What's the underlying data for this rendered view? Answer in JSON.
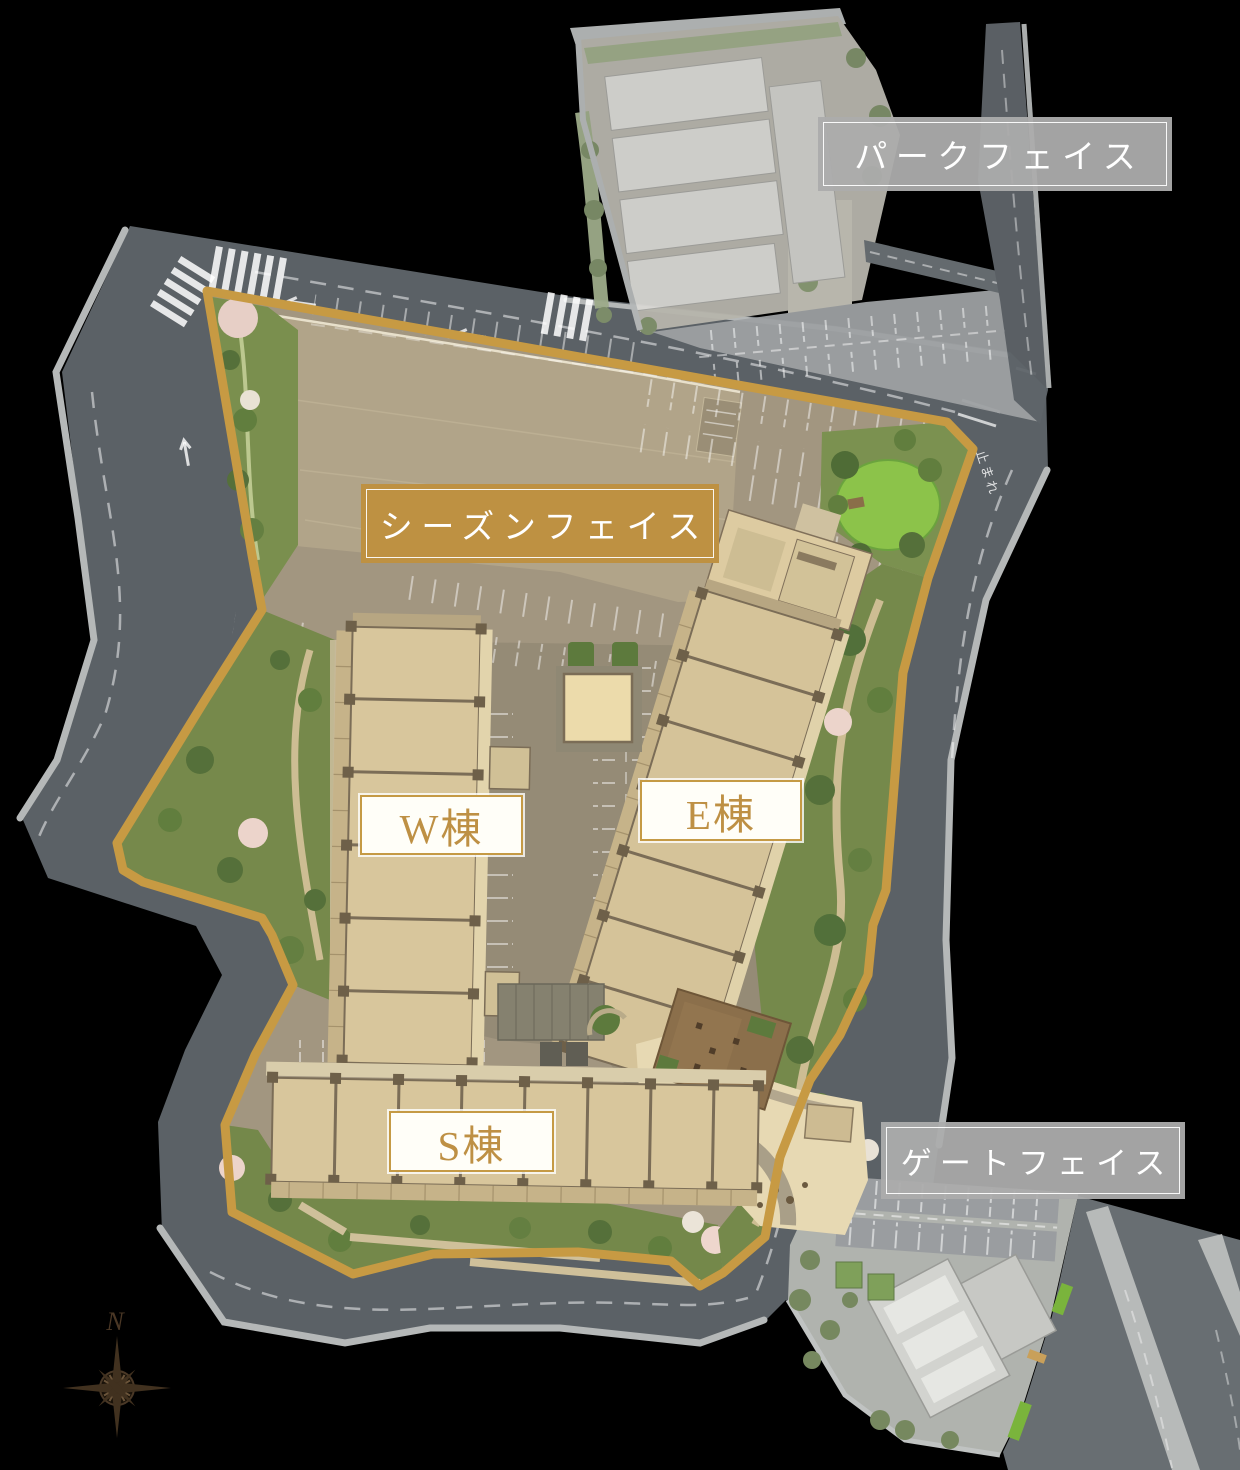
{
  "labels": {
    "park_face": "パークフェイス",
    "season_face": "シーズンフェイス",
    "w_building": "W棟",
    "e_building": "E棟",
    "s_building": "S棟",
    "gate_face": "ゲートフェイス"
  },
  "map": {
    "compass_north": "N",
    "road_marking_stop": "止まれ"
  },
  "colors": {
    "background": "#000000",
    "site_border_gold": "#C79A43",
    "gold_label_bg": "#BE9142",
    "gray_label_bg": "#ACACAC",
    "building_label_text": "#BE9044",
    "building_fill": "#D8C69C",
    "road": "#5B6166",
    "sidewalk": "#B5B8B8",
    "asphalt": "#A0947E",
    "lawn": "#8CC34A",
    "garden_green": "#76894B",
    "cherry_blossom": "#ECD4CB"
  }
}
